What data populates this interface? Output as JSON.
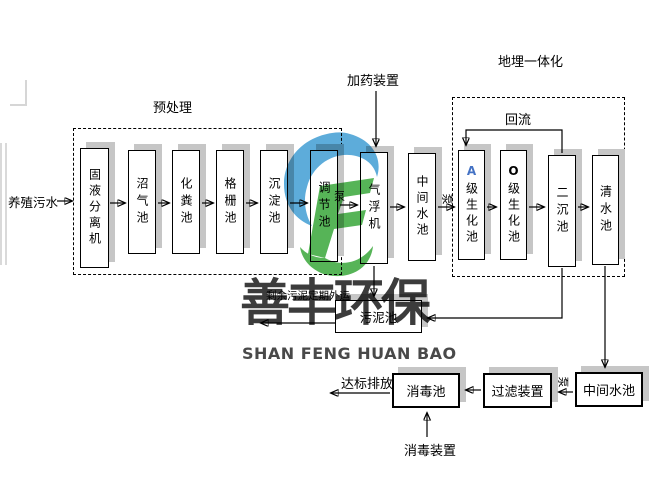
{
  "labels": {
    "influent": "养殖污水",
    "pretreatment": "预处理",
    "dosing_device": "加药装置",
    "buried_integration": "地埋一体化",
    "reflux": "回流",
    "pump": "泵",
    "sludge_export": "剩余污泥定期外运",
    "discharge": "达标排放",
    "disinfection_device": "消毒装置"
  },
  "pretreatment_units": [
    {
      "label": "固液分离机"
    },
    {
      "label": "沼气池"
    },
    {
      "label": "化粪池"
    },
    {
      "label": "格栅池"
    },
    {
      "label": "沉淀池"
    },
    {
      "label": "调节池"
    }
  ],
  "process_units": [
    {
      "label": "气浮机"
    },
    {
      "label": "中间水池"
    }
  ],
  "integration_units": [
    {
      "prefix": "A",
      "rest": "级生化池"
    },
    {
      "prefix": "O",
      "rest": "级生化池"
    },
    {
      "label": "二沉池"
    },
    {
      "label": "清水池"
    }
  ],
  "sludge_tank": {
    "label": "污泥池"
  },
  "tertiary_units": [
    {
      "label": "中间水池"
    },
    {
      "label": "过滤装置"
    },
    {
      "label": "消毒池"
    }
  ],
  "watermark": {
    "cn": "善丰环保",
    "en": "SHAN FENG HUAN BAO",
    "blue": "#54a8d8",
    "green": "#4db04e"
  },
  "colors": {
    "shadow": "#c6c6c6",
    "a_prefix": "#4472c4"
  }
}
